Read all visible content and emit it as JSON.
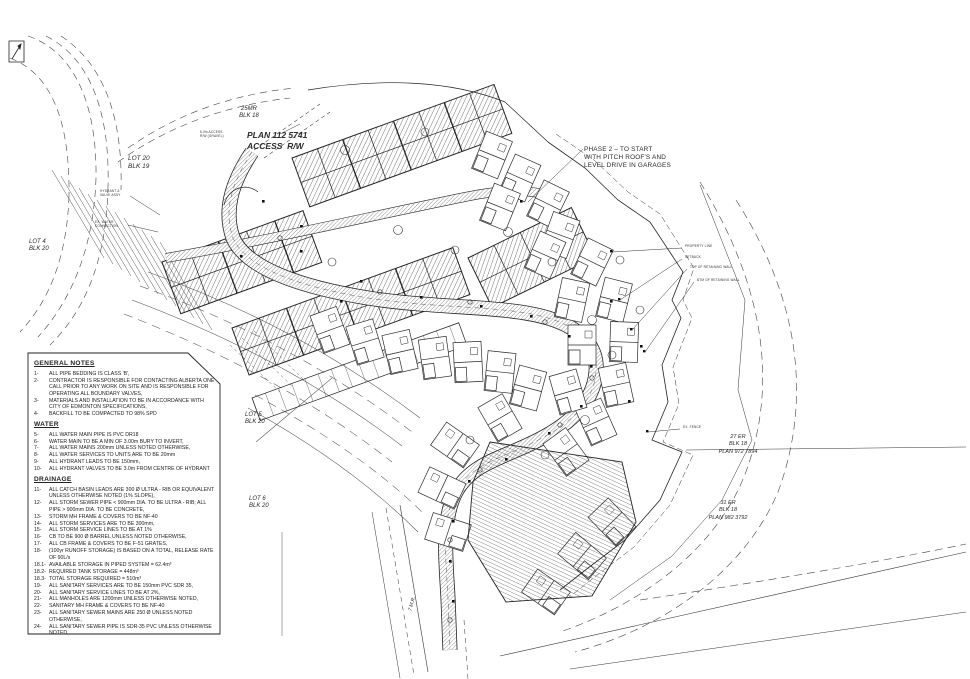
{
  "drawing_title": "Subdivision Site Servicing Plan",
  "labels": {
    "mr25": {
      "lines": [
        "25MR",
        "BLK 18"
      ]
    },
    "plan_access": {
      "lines": [
        "PLAN 112 5741",
        "ACCESS  R/W"
      ]
    },
    "lot20": {
      "lines": [
        "LOT 20",
        "BLK 19"
      ]
    },
    "lot4": {
      "lines": [
        "LOT 4",
        "BLK 20"
      ]
    },
    "lot5": {
      "lines": [
        "LOT 5",
        "BLK 20"
      ]
    },
    "lot6": {
      "lines": [
        "LOT 6",
        "BLK 20"
      ]
    },
    "er27": {
      "lines": [
        "27 ER",
        "BLK 18",
        "PLAN 972 7894"
      ]
    },
    "er31": {
      "lines": [
        "31 ER",
        "BLK 18",
        "PLAN 982 3792"
      ]
    },
    "phase2": {
      "lines": [
        "PHASE 2 – TO START",
        "WITH PITCH ROOF'S AND",
        "LEVEL DRIVE IN GARAGES"
      ]
    },
    "mr7": {
      "lines": [
        "7 M.R."
      ]
    }
  },
  "annotations": {
    "a1": {
      "lines": [
        "PROPERTY LINE"
      ]
    },
    "a2": {
      "lines": [
        "SETBACK"
      ]
    },
    "a3": {
      "lines": [
        "TOP OF RETAINING WALL"
      ]
    },
    "a4": {
      "lines": [
        "BTM OF RETAINING WALL"
      ]
    },
    "a5": {
      "lines": [
        "EX. FENCE"
      ]
    },
    "a6": {
      "lines": [
        "HYDRANT &",
        "VALVE ASSY"
      ]
    },
    "a7": {
      "lines": [
        "EX. WATER",
        "CONNECTION"
      ]
    },
    "a8": {
      "lines": [
        "6.0m ACCESS",
        "R/W (GRAVEL)"
      ]
    }
  },
  "notes": {
    "sections": [
      {
        "heading": "GENERAL NOTES",
        "items": [
          {
            "num": "1-",
            "text": "ALL PIPE BEDDING IS CLASS 'B',"
          },
          {
            "num": "2-",
            "text": "CONTRACTOR IS RESPONSIBLE FOR CONTACTING ALBERTA ONE CALL PRIOR TO ANY WORK ON SITE AND IS RESPONSIBLE FOR OPERATING ALL BOUNDARY VALVES,"
          },
          {
            "num": "3-",
            "text": "MATERIALS AND INSTALLATION TO BE IN ACCORDANCE WITH CITY OF EDMONTON SPECIFICATIONS,"
          },
          {
            "num": "4-",
            "text": "BACKFILL TO BE COMPACTED TO 98% SPD"
          }
        ]
      },
      {
        "heading": "WATER",
        "items": [
          {
            "num": "5-",
            "text": "ALL WATER MAIN PIPE IS PVC DR18"
          },
          {
            "num": "6-",
            "text": "WATER MAIN TO BE A MIN OF 3.00m BURY TO INVERT,"
          },
          {
            "num": "7-",
            "text": "ALL WATER MAINS 200mm UNLESS NOTED OTHERWISE,"
          },
          {
            "num": "8-",
            "text": "ALL WATER SERVICES TO UNITS ARE TO BE 20mm"
          },
          {
            "num": "9-",
            "text": "ALL HYDRANT LEADS TO BE 150mm,"
          },
          {
            "num": "10-",
            "text": "ALL HYDRANT VALVES TO BE 3.0m FROM CENTRE OF HYDRANT"
          }
        ]
      },
      {
        "heading": "DRAINAGE",
        "items": [
          {
            "num": "11-",
            "text": "ALL CATCH BASIN LEADS ARE 300 Ø ULTRA - RIB OR EQUIVALENT UNLESS OTHERWISE NOTED (1% SLOPE),"
          },
          {
            "num": "12-",
            "text": "ALL STORM SEWER PIPE < 900mm DIA. TO BE ULTRA - RIB; ALL PIPE > 900mm DIA. TO BE CONCRETE,"
          },
          {
            "num": "13-",
            "text": "STORM MH FRAME & COVERS TO BE NF-40"
          },
          {
            "num": "14-",
            "text": "ALL STORM SERVICES ARE TO BE 300mm,"
          },
          {
            "num": "15-",
            "text": "ALL STORM SERVICE LINES TO BE AT 1%"
          },
          {
            "num": "16-",
            "text": "CB TO BE 900 Ø BARREL UNLESS NOTED OTHERWISE,"
          },
          {
            "num": "17-",
            "text": "ALL CB FRAME & COVERS TO BE F-51 GRATES,"
          },
          {
            "num": "18-",
            "text": "(100yr RUNOFF STORAGE) IS BASED ON A TOTAL, RELEASE RATE OF 90L/s"
          },
          {
            "num": "18.1-",
            "text": "AVAILABLE STORAGE IN PIPED SYSTEM = 62.4m³"
          },
          {
            "num": "18.2-",
            "text": "REQUIRED TANK STORAGE = 448m³"
          },
          {
            "num": "18.3-",
            "text": "TOTAL STORAGE REQUIRED = 510m³"
          },
          {
            "num": "19-",
            "text": "ALL SANITARY SERVICES ARE TO BE 150mm PVC SDR 35,"
          },
          {
            "num": "20-",
            "text": "ALL SANITARY SERVICE LINES TO BE AT 2%,"
          },
          {
            "num": "21-",
            "text": "ALL MANHOLES ARE 1200mm UNLESS OTHERWISE NOTED,"
          },
          {
            "num": "22-",
            "text": "SANITARY MH FRAME & COVERS TO BE NF-40"
          },
          {
            "num": "23-",
            "text": "ALL SANITARY SEWER MAINS ARE 250 Ø UNLESS NOTED OTHERWISE,"
          },
          {
            "num": "24-",
            "text": "ALL SANITARY SEWER PIPE IS SDR-35 PVC UNLESS OTHERWISE NOTED,"
          }
        ]
      }
    ]
  },
  "colors": {
    "line": "#2a2a2a",
    "paper": "#ffffff"
  }
}
